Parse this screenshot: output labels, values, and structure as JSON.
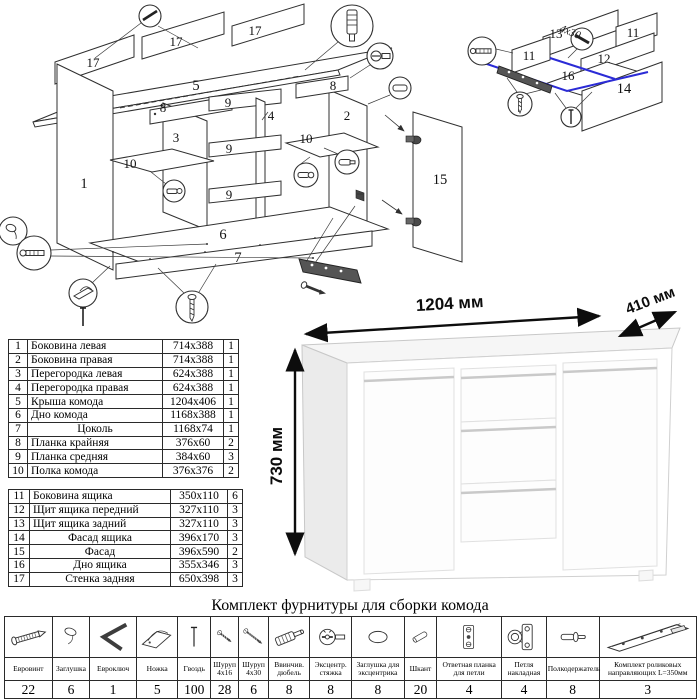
{
  "main_diagram": {
    "part_labels": [
      "17",
      "17",
      "17",
      "5",
      "1",
      "8",
      "3",
      "9",
      "4",
      "2",
      "8",
      "9",
      "10",
      "10",
      "9",
      "6",
      "7",
      "15"
    ]
  },
  "drawer_diagram": {
    "part_labels": [
      "13",
      "11",
      "11",
      "12",
      "16",
      "14"
    ],
    "screw_note": "4x30"
  },
  "render": {
    "width_label": "1204 мм",
    "depth_label": "410 мм",
    "height_label": "730 мм"
  },
  "parts_table": {
    "rows": [
      {
        "num": "1",
        "name": "Боковина левая",
        "size": "714x388",
        "qty": "1"
      },
      {
        "num": "2",
        "name": "Боковина правая",
        "size": "714x388",
        "qty": "1"
      },
      {
        "num": "3",
        "name": "Перегородка левая",
        "size": "624x388",
        "qty": "1"
      },
      {
        "num": "4",
        "name": "Перегородка правая",
        "size": "624x388",
        "qty": "1"
      },
      {
        "num": "5",
        "name": "Крыша комода",
        "size": "1204x406",
        "qty": "1"
      },
      {
        "num": "6",
        "name": "Дно комода",
        "size": "1168x388",
        "qty": "1"
      },
      {
        "num": "7",
        "name": "Цоколь",
        "size": "1168x74",
        "qty": "1"
      },
      {
        "num": "8",
        "name": "Планка крайняя",
        "size": "376x60",
        "qty": "2"
      },
      {
        "num": "9",
        "name": "Планка средняя",
        "size": "384x60",
        "qty": "3"
      },
      {
        "num": "10",
        "name": "Полка комода",
        "size": "376x376",
        "qty": "2"
      },
      {
        "num": "11",
        "name": "Боковина ящика",
        "size": "350x110",
        "qty": "6"
      },
      {
        "num": "12",
        "name": "Щит ящика передний",
        "size": "327x110",
        "qty": "3"
      },
      {
        "num": "13",
        "name": "Щит ящика задний",
        "size": "327x110",
        "qty": "3"
      },
      {
        "num": "14",
        "name": "Фасад ящика",
        "size": "396x170",
        "qty": "3"
      },
      {
        "num": "15",
        "name": "Фасад",
        "size": "396x590",
        "qty": "2"
      },
      {
        "num": "16",
        "name": "Дно ящика",
        "size": "355x346",
        "qty": "3"
      },
      {
        "num": "17",
        "name": "Стенка задняя",
        "size": "650x398",
        "qty": "3"
      }
    ]
  },
  "hardware": {
    "title": "Комплект фурнитуры для сборки комода",
    "items": [
      {
        "icon": "euro-screw-icon",
        "label": "Евровинт",
        "qty": "22"
      },
      {
        "icon": "plug-icon",
        "label": "Заглушка",
        "qty": "6"
      },
      {
        "icon": "hex-key-icon",
        "label": "Евроключ",
        "qty": "1"
      },
      {
        "icon": "foot-icon",
        "label": "Ножка",
        "qty": "5"
      },
      {
        "icon": "nail-icon",
        "label": "Гвоздь",
        "qty": "100"
      },
      {
        "icon": "screw-short-icon",
        "label": "Шуруп 4x16",
        "qty": "28"
      },
      {
        "icon": "screw-long-icon",
        "label": "Шуруп 4x30",
        "qty": "6"
      },
      {
        "icon": "threaded-dowel-icon",
        "label": "Ввинчив. дюбель",
        "qty": "8"
      },
      {
        "icon": "cam-lock-icon",
        "label": "Эксцентр. стяжка",
        "qty": "8"
      },
      {
        "icon": "cam-cover-icon",
        "label": "Заглушка для эксцентрика",
        "qty": "8"
      },
      {
        "icon": "wood-dowel-icon",
        "label": "Шкант",
        "qty": "20"
      },
      {
        "icon": "hinge-plate-icon",
        "label": "Ответная планка для петли",
        "qty": "4"
      },
      {
        "icon": "hinge-icon",
        "label": "Петля накладная",
        "qty": "4"
      },
      {
        "icon": "shelf-support-icon",
        "label": "Полкодержатель",
        "qty": "8"
      },
      {
        "icon": "roller-guides-icon",
        "label": "Комплект роликовых направляющих L=350мм",
        "qty": "3"
      }
    ]
  }
}
